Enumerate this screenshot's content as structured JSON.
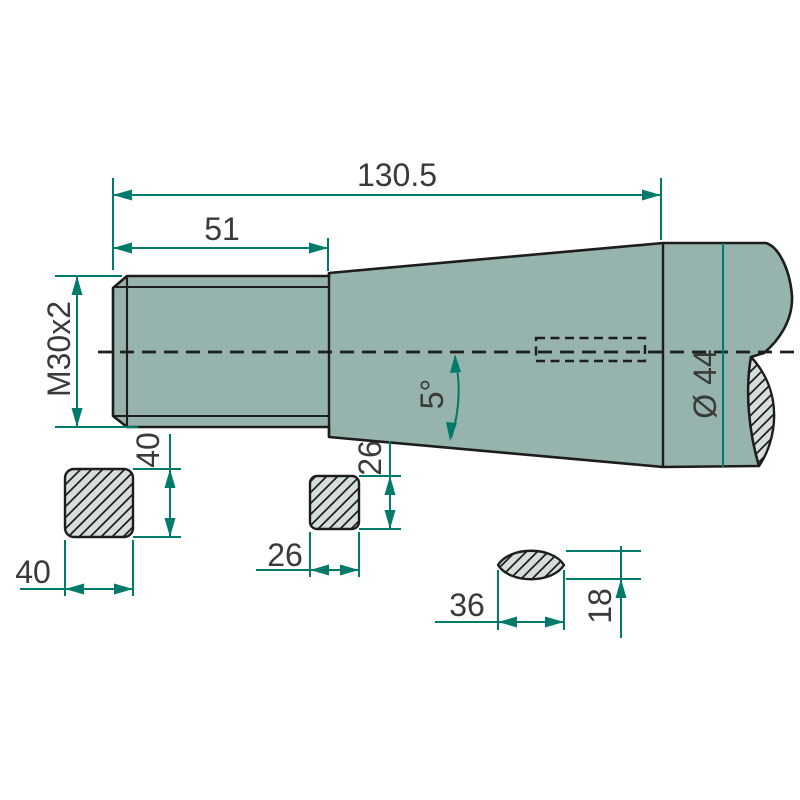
{
  "drawing": {
    "type": "technical-drawing",
    "labels": {
      "overall_length": "130.5",
      "thread_length": "51",
      "thread_spec": "M30x2",
      "taper_angle": "5°",
      "shaft_diameter": "Ø 44",
      "square1_side_vertical": "40",
      "square1_side_horizontal": "40",
      "square2_side_vertical": "26",
      "square2_side_horizontal": "26",
      "lens_section_width": "36",
      "lens_section_height": "18"
    },
    "colors": {
      "background": "#ffffff",
      "body-fill": "#96b3ad",
      "section-fill": "#d5ded9",
      "outline": "#1d1d1b",
      "dimension": "#007a6a",
      "text": "#3a3a38"
    }
  }
}
